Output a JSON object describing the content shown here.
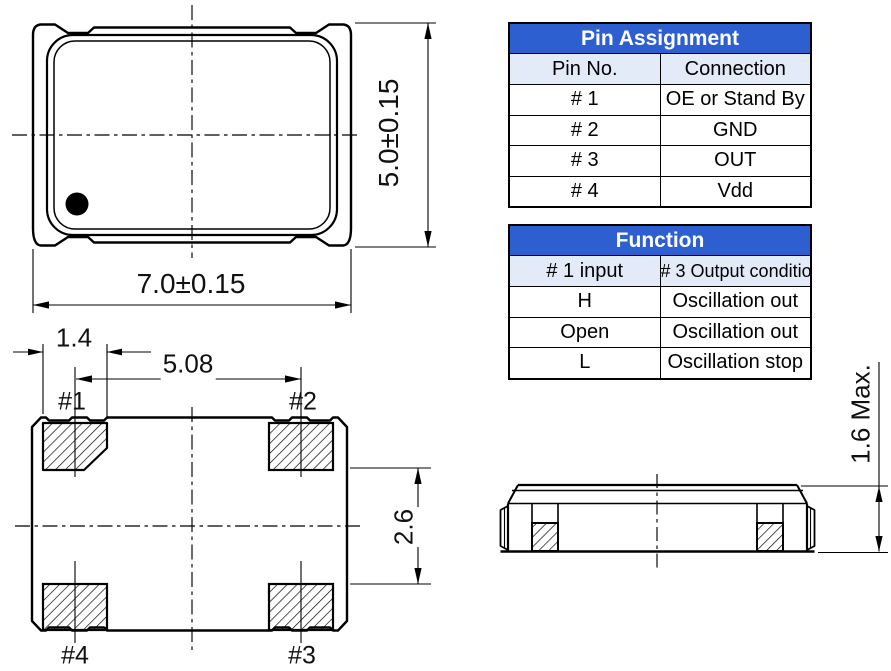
{
  "colors": {
    "table_header_bg": "#2d5fd0",
    "table_header_text": "#ffffff",
    "table_subheader_bg": "#e4ebf8",
    "line_color": "#000000"
  },
  "top_view": {
    "width_dim": "7.0±0.15",
    "height_dim": "5.0±0.15"
  },
  "bottom_view": {
    "pad_width_dim": "1.4",
    "pad_pitch_dim": "5.08",
    "pad_gap_dim": "2.6",
    "pad_labels": [
      "#1",
      "#2",
      "#3",
      "#4"
    ]
  },
  "side_view": {
    "height_dim": "1.6 Max."
  },
  "pin_assignment_table": {
    "title": "Pin Assignment",
    "columns": [
      "Pin No.",
      "Connection"
    ],
    "rows": [
      [
        "# 1",
        "OE or Stand By"
      ],
      [
        "# 2",
        "GND"
      ],
      [
        "# 3",
        "OUT"
      ],
      [
        "# 4",
        "Vdd"
      ]
    ]
  },
  "function_table": {
    "title": "Function",
    "columns": [
      "# 1 input",
      "# 3 Output condition"
    ],
    "rows": [
      [
        "H",
        "Oscillation out"
      ],
      [
        "Open",
        "Oscillation out"
      ],
      [
        "L",
        "Oscillation stop"
      ]
    ]
  }
}
